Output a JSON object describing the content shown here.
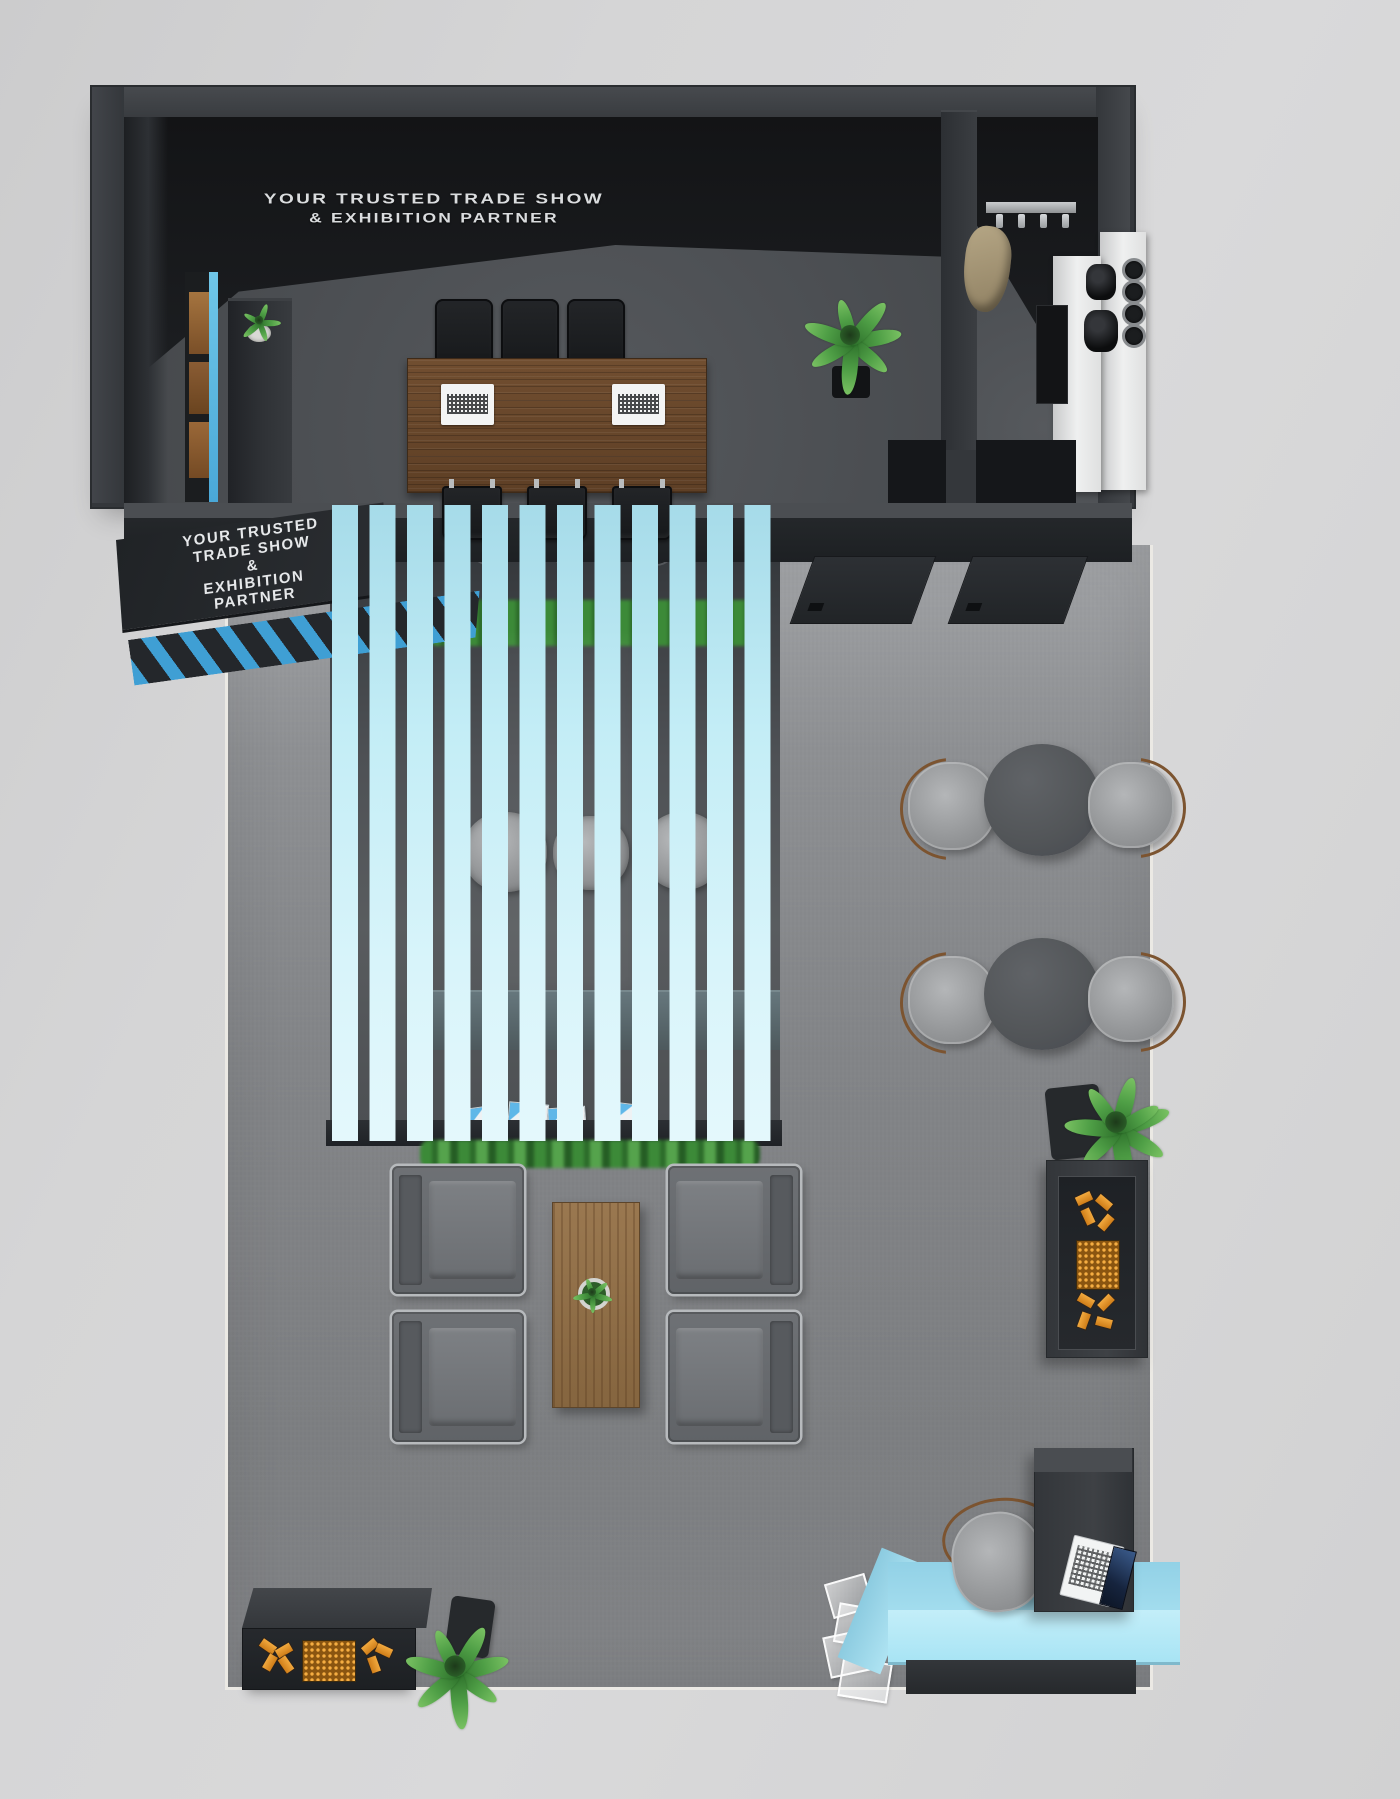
{
  "meta": {
    "description": "Top-down 3D render of a trade show exhibition booth design"
  },
  "signage": {
    "back_wall": {
      "line1": "YOUR TRUSTED TRADE SHOW",
      "line2": "& EXHIBITION PARTNER"
    },
    "fascia": {
      "line1": "YOUR TRUSTED",
      "line2": "TRADE SHOW",
      "line3": "&",
      "line4": "EXHIBITION",
      "line5": "PARTNER"
    }
  },
  "palette": {
    "background_floor": "#d4d4d5",
    "booth_carpet": "#838588",
    "structure_wall": "#34373b",
    "ceiling_black": "#151618",
    "accent_cyan_slats": "#c3edf6",
    "stripe_blue": "#3f9fd4",
    "conference_table_wood": "#6b4a2f",
    "coffee_table_wood": "#8f6e47",
    "armchair_gray": "#6a6d71",
    "boucle_chair_gray": "#9fa1a3",
    "product_orange": "#e8952c",
    "plant_green": "#3f9040",
    "pantry_counter_white": "#eceded",
    "reception_desk_cyan": "#aee3f2"
  }
}
